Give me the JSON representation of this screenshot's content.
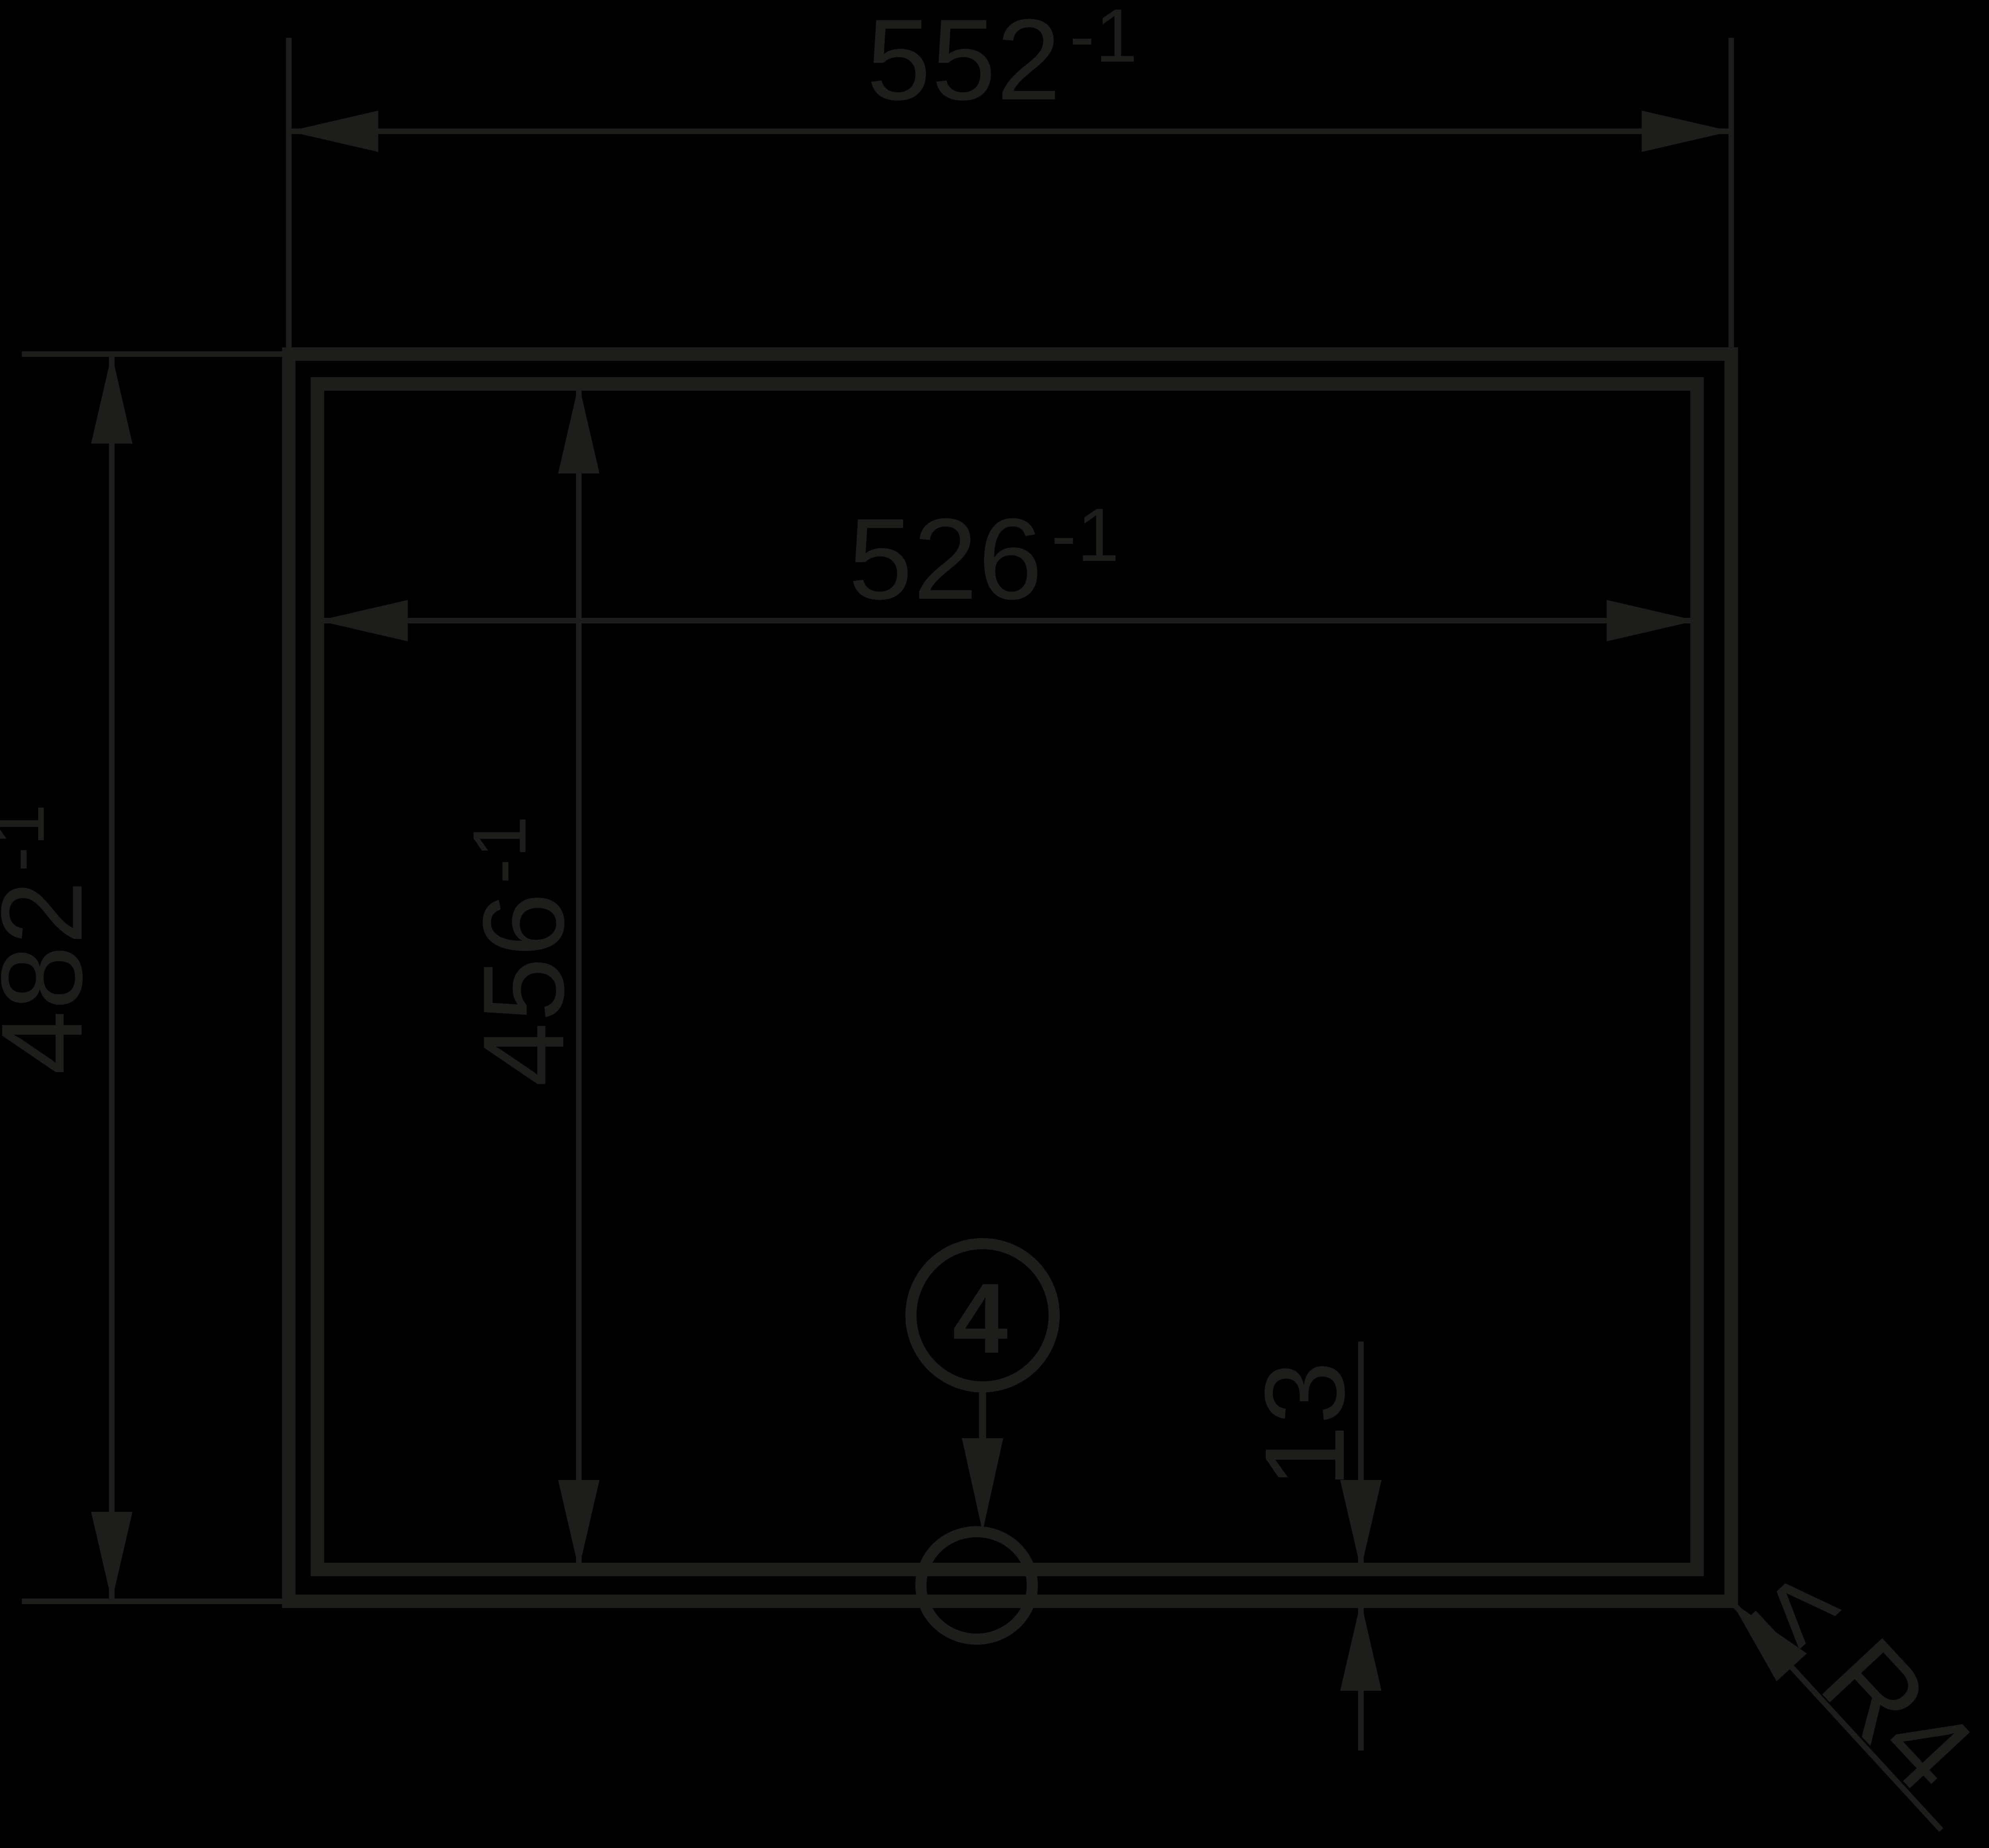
{
  "colors": {
    "background": "#000000",
    "ink": "#1d1d1b"
  },
  "drawing_type": "technical dimension drawing (cutout front view)",
  "dimensions": {
    "outer_width": {
      "value": "552",
      "tolerance": "-1"
    },
    "inner_width": {
      "value": "526",
      "tolerance": "-1"
    },
    "outer_height": {
      "value": "482",
      "tolerance": "-1"
    },
    "inner_height": {
      "value": "456",
      "tolerance": "-1"
    },
    "bottom_edge_offset": {
      "value": "13",
      "tolerance": ""
    }
  },
  "callout": {
    "number": "4"
  },
  "corner_note": {
    "text": "≤ R4"
  }
}
